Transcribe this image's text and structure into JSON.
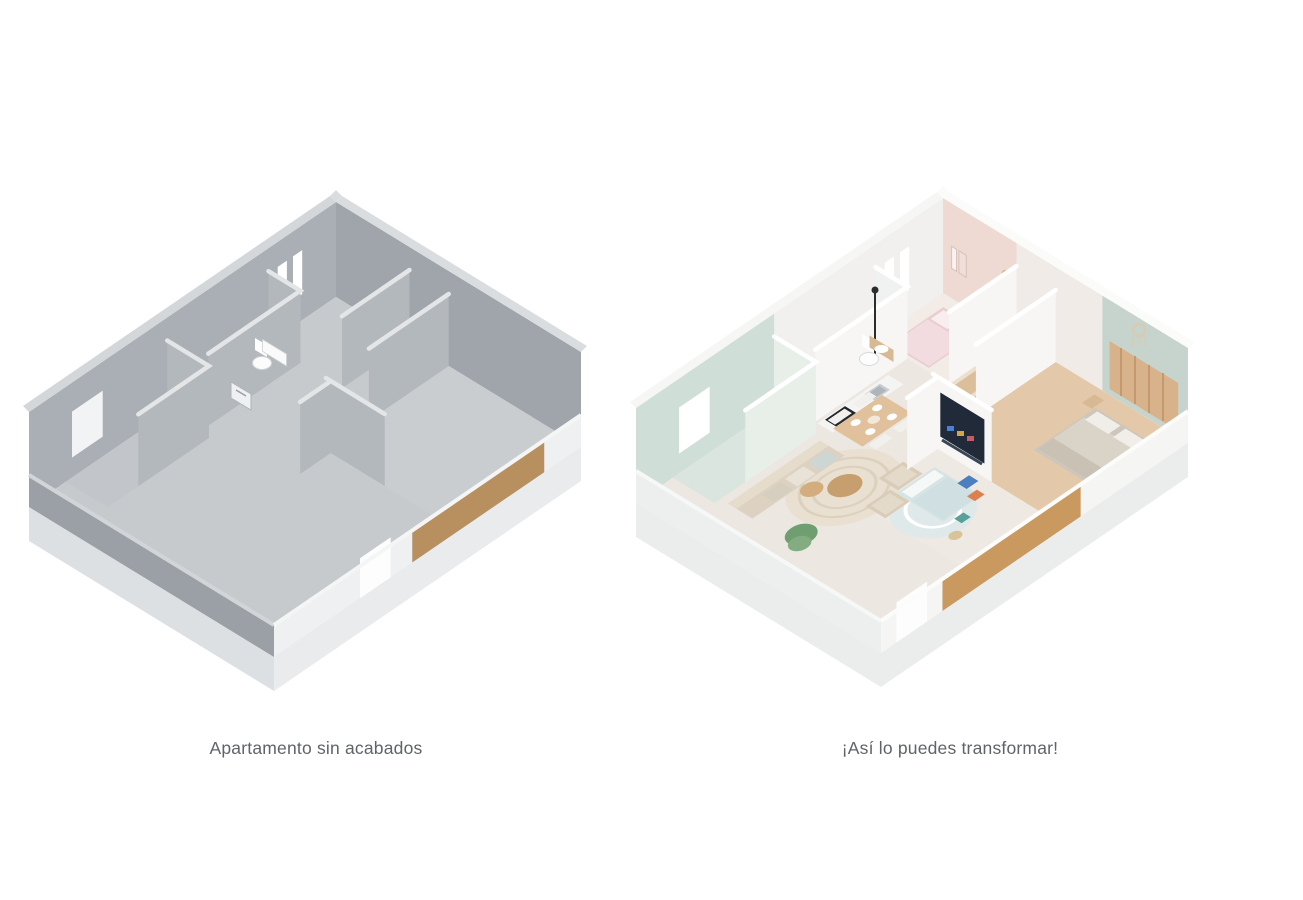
{
  "figures": {
    "before": {
      "caption": "Apartamento sin acabados",
      "alt_name": "unfinished-apartment-3d-floorplan"
    },
    "after": {
      "caption": "¡Así lo puedes transformar!",
      "alt_name": "furnished-apartment-3d-floorplan"
    }
  },
  "palette": {
    "page_background": "#ffffff",
    "caption_text": "#5f6468",
    "unfinished_wall": "#9fa5ab",
    "unfinished_floor": "#c6cacd",
    "wood_accent_unfinished": "#b8905f",
    "furnished_pink_wall": "#eed9d3",
    "furnished_sage_wall": "#c6d4cd",
    "furnished_mint_wall": "#cfdfd7",
    "furnished_floor": "#ece7e1",
    "furnished_wood_floor": "#e3c9a9",
    "wood_accent_furnished": "#c9995f",
    "tv_screen": "#202a38"
  }
}
